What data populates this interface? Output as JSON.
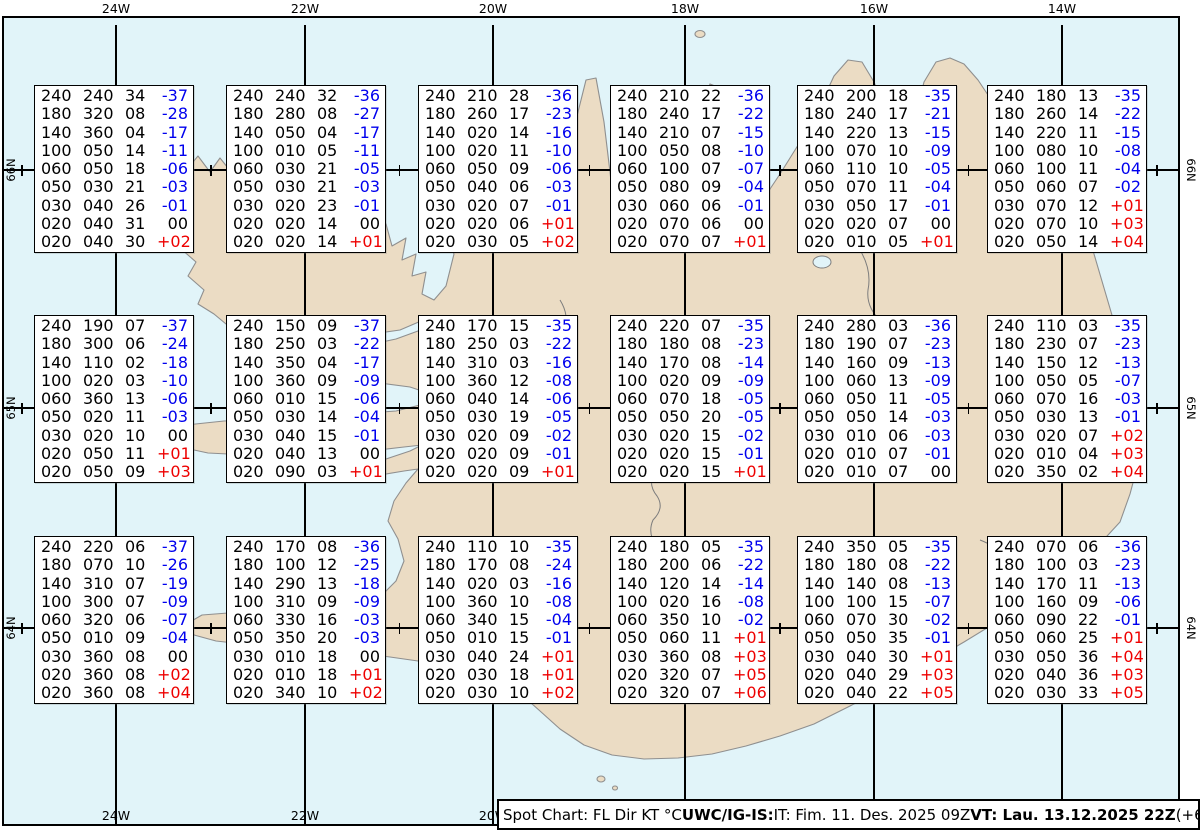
{
  "colors": {
    "sea": "#e1f4f9",
    "land": "#ebdcc4",
    "coast": "#8f8f8f",
    "grid": "#000000",
    "temp_negative": "#0000ee",
    "temp_positive": "#ee0000",
    "temp_zero": "#000000"
  },
  "map": {
    "meridians": [
      {
        "label": "24W",
        "x": 116
      },
      {
        "label": "22W",
        "x": 305
      },
      {
        "label": "20W",
        "x": 493
      },
      {
        "label": "18W",
        "x": 685
      },
      {
        "label": "16W",
        "x": 874
      },
      {
        "label": "14W",
        "x": 1062
      }
    ],
    "parallels": [
      {
        "label": "66N",
        "y": 170
      },
      {
        "label": "65N",
        "y": 408
      },
      {
        "label": "64N",
        "y": 628
      }
    ]
  },
  "status_bar": {
    "segments": [
      {
        "text": "Spot Chart: FL Dir KT °C ",
        "bold": false
      },
      {
        "text": "UWC/IG-IS:",
        "bold": true
      },
      {
        "text": " IT: Fim. 11. Des. 2025 09Z ",
        "bold": false
      },
      {
        "text": "VT: Lau. 13.12.2025 22Z",
        "bold": true
      },
      {
        "text": " (+61 h)",
        "bold": false
      }
    ]
  },
  "chart_data": {
    "type": "table",
    "title": "Spot Chart: FL Dir KT °C",
    "issued": "IT: Fim. 11. Des. 2025 09Z",
    "valid": "VT: Lau. 13.12.2025 22Z (+61 h)",
    "lead_time": "(+61 h)",
    "source": "UWC/IG-IS:",
    "columns": [
      "FL",
      "Dir",
      "KT",
      "TempC"
    ],
    "stations": [
      {
        "row": 0,
        "col": 0,
        "levels": [
          [
            "240",
            "240",
            "34",
            "-37"
          ],
          [
            "180",
            "320",
            "08",
            "-28"
          ],
          [
            "140",
            "360",
            "04",
            "-17"
          ],
          [
            "100",
            "050",
            "14",
            "-11"
          ],
          [
            "060",
            "050",
            "18",
            "-06"
          ],
          [
            "050",
            "030",
            "21",
            "-03"
          ],
          [
            "030",
            "040",
            "26",
            "-01"
          ],
          [
            "020",
            "040",
            "31",
            "00"
          ],
          [
            "020",
            "040",
            "30",
            "+02"
          ]
        ]
      },
      {
        "row": 0,
        "col": 1,
        "levels": [
          [
            "240",
            "240",
            "32",
            "-36"
          ],
          [
            "180",
            "280",
            "08",
            "-27"
          ],
          [
            "140",
            "050",
            "04",
            "-17"
          ],
          [
            "100",
            "010",
            "05",
            "-11"
          ],
          [
            "060",
            "030",
            "21",
            "-05"
          ],
          [
            "050",
            "030",
            "21",
            "-03"
          ],
          [
            "030",
            "020",
            "23",
            "-01"
          ],
          [
            "020",
            "020",
            "14",
            "00"
          ],
          [
            "020",
            "020",
            "14",
            "+01"
          ]
        ]
      },
      {
        "row": 0,
        "col": 2,
        "levels": [
          [
            "240",
            "210",
            "28",
            "-36"
          ],
          [
            "180",
            "260",
            "17",
            "-23"
          ],
          [
            "140",
            "020",
            "14",
            "-16"
          ],
          [
            "100",
            "020",
            "11",
            "-10"
          ],
          [
            "060",
            "050",
            "09",
            "-06"
          ],
          [
            "050",
            "040",
            "06",
            "-03"
          ],
          [
            "030",
            "020",
            "07",
            "-01"
          ],
          [
            "020",
            "020",
            "06",
            "+01"
          ],
          [
            "020",
            "030",
            "05",
            "+02"
          ]
        ]
      },
      {
        "row": 0,
        "col": 3,
        "levels": [
          [
            "240",
            "210",
            "22",
            "-36"
          ],
          [
            "180",
            "240",
            "17",
            "-22"
          ],
          [
            "140",
            "210",
            "07",
            "-15"
          ],
          [
            "100",
            "050",
            "08",
            "-10"
          ],
          [
            "060",
            "100",
            "07",
            "-07"
          ],
          [
            "050",
            "080",
            "09",
            "-04"
          ],
          [
            "030",
            "060",
            "06",
            "-01"
          ],
          [
            "020",
            "070",
            "06",
            "00"
          ],
          [
            "020",
            "070",
            "07",
            "+01"
          ]
        ]
      },
      {
        "row": 0,
        "col": 4,
        "levels": [
          [
            "240",
            "200",
            "18",
            "-35"
          ],
          [
            "180",
            "240",
            "17",
            "-21"
          ],
          [
            "140",
            "220",
            "13",
            "-15"
          ],
          [
            "100",
            "070",
            "10",
            "-09"
          ],
          [
            "060",
            "110",
            "10",
            "-05"
          ],
          [
            "050",
            "070",
            "11",
            "-04"
          ],
          [
            "030",
            "050",
            "17",
            "-01"
          ],
          [
            "020",
            "020",
            "07",
            "00"
          ],
          [
            "020",
            "010",
            "05",
            "+01"
          ]
        ]
      },
      {
        "row": 0,
        "col": 5,
        "levels": [
          [
            "240",
            "180",
            "13",
            "-35"
          ],
          [
            "180",
            "260",
            "14",
            "-22"
          ],
          [
            "140",
            "220",
            "11",
            "-15"
          ],
          [
            "100",
            "080",
            "10",
            "-08"
          ],
          [
            "060",
            "100",
            "11",
            "-04"
          ],
          [
            "050",
            "060",
            "07",
            "-02"
          ],
          [
            "030",
            "070",
            "12",
            "+01"
          ],
          [
            "020",
            "070",
            "10",
            "+03"
          ],
          [
            "020",
            "050",
            "14",
            "+04"
          ]
        ]
      },
      {
        "row": 1,
        "col": 0,
        "levels": [
          [
            "240",
            "190",
            "07",
            "-37"
          ],
          [
            "180",
            "300",
            "06",
            "-24"
          ],
          [
            "140",
            "110",
            "02",
            "-18"
          ],
          [
            "100",
            "020",
            "03",
            "-10"
          ],
          [
            "060",
            "360",
            "13",
            "-06"
          ],
          [
            "050",
            "020",
            "11",
            "-03"
          ],
          [
            "030",
            "020",
            "10",
            "00"
          ],
          [
            "020",
            "050",
            "11",
            "+01"
          ],
          [
            "020",
            "050",
            "09",
            "+03"
          ]
        ]
      },
      {
        "row": 1,
        "col": 1,
        "levels": [
          [
            "240",
            "150",
            "09",
            "-37"
          ],
          [
            "180",
            "250",
            "03",
            "-22"
          ],
          [
            "140",
            "350",
            "04",
            "-17"
          ],
          [
            "100",
            "360",
            "09",
            "-09"
          ],
          [
            "060",
            "010",
            "15",
            "-06"
          ],
          [
            "050",
            "030",
            "14",
            "-04"
          ],
          [
            "030",
            "040",
            "15",
            "-01"
          ],
          [
            "020",
            "040",
            "13",
            "00"
          ],
          [
            "020",
            "090",
            "03",
            "+01"
          ]
        ]
      },
      {
        "row": 1,
        "col": 2,
        "levels": [
          [
            "240",
            "170",
            "15",
            "-35"
          ],
          [
            "180",
            "250",
            "03",
            "-22"
          ],
          [
            "140",
            "310",
            "03",
            "-16"
          ],
          [
            "100",
            "360",
            "12",
            "-08"
          ],
          [
            "060",
            "040",
            "14",
            "-06"
          ],
          [
            "050",
            "030",
            "19",
            "-05"
          ],
          [
            "030",
            "020",
            "09",
            "-02"
          ],
          [
            "020",
            "020",
            "09",
            "-01"
          ],
          [
            "020",
            "020",
            "09",
            "+01"
          ]
        ]
      },
      {
        "row": 1,
        "col": 3,
        "levels": [
          [
            "240",
            "220",
            "07",
            "-35"
          ],
          [
            "180",
            "180",
            "08",
            "-23"
          ],
          [
            "140",
            "170",
            "08",
            "-14"
          ],
          [
            "100",
            "020",
            "09",
            "-09"
          ],
          [
            "060",
            "070",
            "18",
            "-05"
          ],
          [
            "050",
            "050",
            "20",
            "-05"
          ],
          [
            "030",
            "020",
            "15",
            "-02"
          ],
          [
            "020",
            "020",
            "15",
            "-01"
          ],
          [
            "020",
            "020",
            "15",
            "+01"
          ]
        ]
      },
      {
        "row": 1,
        "col": 4,
        "levels": [
          [
            "240",
            "280",
            "03",
            "-36"
          ],
          [
            "180",
            "190",
            "07",
            "-23"
          ],
          [
            "140",
            "160",
            "09",
            "-13"
          ],
          [
            "100",
            "060",
            "13",
            "-09"
          ],
          [
            "060",
            "050",
            "11",
            "-05"
          ],
          [
            "050",
            "050",
            "14",
            "-03"
          ],
          [
            "030",
            "010",
            "06",
            "-03"
          ],
          [
            "020",
            "010",
            "07",
            "-01"
          ],
          [
            "020",
            "010",
            "07",
            "00"
          ]
        ]
      },
      {
        "row": 1,
        "col": 5,
        "levels": [
          [
            "240",
            "110",
            "03",
            "-35"
          ],
          [
            "180",
            "230",
            "07",
            "-23"
          ],
          [
            "140",
            "150",
            "12",
            "-13"
          ],
          [
            "100",
            "050",
            "05",
            "-07"
          ],
          [
            "060",
            "070",
            "16",
            "-03"
          ],
          [
            "050",
            "030",
            "13",
            "-01"
          ],
          [
            "030",
            "020",
            "07",
            "+02"
          ],
          [
            "020",
            "010",
            "04",
            "+03"
          ],
          [
            "020",
            "350",
            "02",
            "+04"
          ]
        ]
      },
      {
        "row": 2,
        "col": 0,
        "levels": [
          [
            "240",
            "220",
            "06",
            "-37"
          ],
          [
            "180",
            "070",
            "10",
            "-26"
          ],
          [
            "140",
            "310",
            "07",
            "-19"
          ],
          [
            "100",
            "300",
            "07",
            "-09"
          ],
          [
            "060",
            "320",
            "06",
            "-07"
          ],
          [
            "050",
            "010",
            "09",
            "-04"
          ],
          [
            "030",
            "360",
            "08",
            "00"
          ],
          [
            "020",
            "360",
            "08",
            "+02"
          ],
          [
            "020",
            "360",
            "08",
            "+04"
          ]
        ]
      },
      {
        "row": 2,
        "col": 1,
        "levels": [
          [
            "240",
            "170",
            "08",
            "-36"
          ],
          [
            "180",
            "100",
            "12",
            "-25"
          ],
          [
            "140",
            "290",
            "13",
            "-18"
          ],
          [
            "100",
            "310",
            "09",
            "-09"
          ],
          [
            "060",
            "330",
            "16",
            "-03"
          ],
          [
            "050",
            "350",
            "20",
            "-03"
          ],
          [
            "030",
            "010",
            "18",
            "00"
          ],
          [
            "020",
            "010",
            "18",
            "+01"
          ],
          [
            "020",
            "340",
            "10",
            "+02"
          ]
        ]
      },
      {
        "row": 2,
        "col": 2,
        "levels": [
          [
            "240",
            "110",
            "10",
            "-35"
          ],
          [
            "180",
            "170",
            "08",
            "-24"
          ],
          [
            "140",
            "020",
            "03",
            "-16"
          ],
          [
            "100",
            "360",
            "10",
            "-08"
          ],
          [
            "060",
            "340",
            "15",
            "-04"
          ],
          [
            "050",
            "010",
            "15",
            "-01"
          ],
          [
            "030",
            "040",
            "24",
            "+01"
          ],
          [
            "020",
            "030",
            "18",
            "+01"
          ],
          [
            "020",
            "030",
            "10",
            "+02"
          ]
        ]
      },
      {
        "row": 2,
        "col": 3,
        "levels": [
          [
            "240",
            "180",
            "05",
            "-35"
          ],
          [
            "180",
            "200",
            "06",
            "-22"
          ],
          [
            "140",
            "120",
            "14",
            "-14"
          ],
          [
            "100",
            "020",
            "16",
            "-08"
          ],
          [
            "060",
            "350",
            "10",
            "-02"
          ],
          [
            "050",
            "060",
            "11",
            "+01"
          ],
          [
            "030",
            "360",
            "08",
            "+03"
          ],
          [
            "020",
            "320",
            "07",
            "+05"
          ],
          [
            "020",
            "320",
            "07",
            "+06"
          ]
        ]
      },
      {
        "row": 2,
        "col": 4,
        "levels": [
          [
            "240",
            "350",
            "05",
            "-35"
          ],
          [
            "180",
            "180",
            "08",
            "-22"
          ],
          [
            "140",
            "140",
            "08",
            "-13"
          ],
          [
            "100",
            "100",
            "15",
            "-07"
          ],
          [
            "060",
            "070",
            "30",
            "-02"
          ],
          [
            "050",
            "050",
            "35",
            "-01"
          ],
          [
            "030",
            "040",
            "30",
            "+01"
          ],
          [
            "020",
            "040",
            "29",
            "+03"
          ],
          [
            "020",
            "040",
            "22",
            "+05"
          ]
        ]
      },
      {
        "row": 2,
        "col": 5,
        "levels": [
          [
            "240",
            "070",
            "06",
            "-36"
          ],
          [
            "180",
            "100",
            "03",
            "-23"
          ],
          [
            "140",
            "170",
            "11",
            "-13"
          ],
          [
            "100",
            "160",
            "09",
            "-06"
          ],
          [
            "060",
            "090",
            "22",
            "-01"
          ],
          [
            "050",
            "060",
            "25",
            "+01"
          ],
          [
            "030",
            "050",
            "36",
            "+04"
          ],
          [
            "020",
            "040",
            "36",
            "+03"
          ],
          [
            "020",
            "030",
            "33",
            "+05"
          ]
        ]
      }
    ]
  }
}
